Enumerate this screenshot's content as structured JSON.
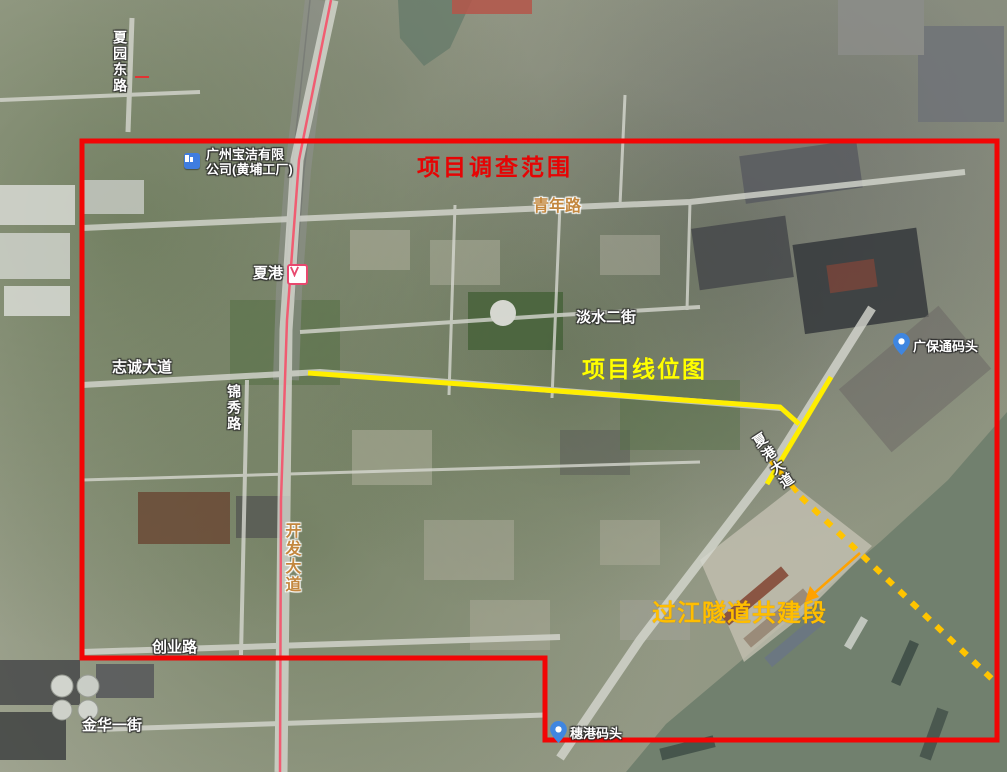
{
  "annotations": {
    "survey_scope": "项目调查范围",
    "route_map": "项目线位图",
    "tunnel_section": "过江隧道共建段"
  },
  "roads": {
    "xiayuan_east": "夏园东路",
    "qingnian": "青年路",
    "zhicheng": "志诚大道",
    "jinxiu": "锦秀路",
    "kaifa": "开发大道",
    "chuangye": "创业路",
    "jinhua": "金华一街",
    "danshui": "淡水二街",
    "xiagang_ave": "夏港大道"
  },
  "pois": {
    "pg_factory_line1": "广州宝洁有限",
    "pg_factory_line2": "公司(黄埔工厂)",
    "metro_station": "夏港",
    "guangbaotong_wharf": "广保通码头",
    "suigang_wharf": "穗港码头"
  },
  "colors": {
    "boundary_red": "#f20505",
    "route_yellow": "#ffee00",
    "tunnel_gold": "#ffc400",
    "arrow_orange": "#ffa200",
    "survey_text_red": "#e60404",
    "route_text_yellow": "#ffff00",
    "tunnel_text_gold": "#ffbe00",
    "metro_line_pink": "#f2566e",
    "poi_pin_blue": "#3f86e0"
  }
}
